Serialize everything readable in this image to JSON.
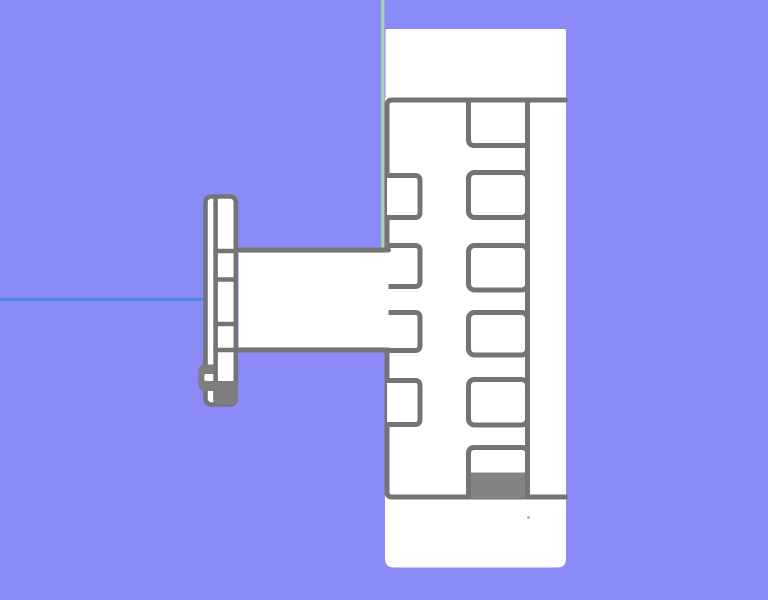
{
  "viewport": {
    "width": 768,
    "height": 600,
    "background": "#8b8bf7"
  },
  "axes": {
    "z_axis": {
      "color": "#a5d7a0",
      "x": 382.8,
      "y1": 0,
      "y2": 249,
      "width": 3.2
    },
    "x_axis": {
      "color": "#4d87e0",
      "y": 299.3,
      "x1": 0,
      "x2": 204,
      "width": 3
    }
  },
  "model": {
    "white": "#ffffff",
    "edge": "#747474",
    "solid": "#838383",
    "bump_fill": "#7e7e7e",
    "stroke_width": 5,
    "top_flange": {
      "x": 385.5,
      "y": 29,
      "w": 180.5,
      "h": 71,
      "r": 2
    },
    "bottom_flange": {
      "x": 385,
      "y": 499,
      "w": 181,
      "h": 68.5,
      "r": 9
    },
    "body": {
      "left": 387,
      "top": 100,
      "right": 565.5,
      "bottom": 497,
      "corner": 5,
      "fill": {
        "x": 385,
        "y": 98,
        "w": 181,
        "h": 401
      }
    },
    "beam": {
      "x1": 237.5,
      "x2": 388.5,
      "top": 250,
      "bottom": 350
    },
    "left_slots": {
      "x": 387,
      "w": 33,
      "r": 5,
      "items": [
        [
          175.5,
          42
        ],
        [
          245.5,
          41
        ],
        [
          312.5,
          38
        ],
        [
          380.5,
          44
        ]
      ]
    },
    "teeth": {
      "x": 468.5,
      "w": 59,
      "r": 6,
      "rail_x": 527.5,
      "top_tooth_bottom_y": 145.5,
      "items": [
        [
          172.5,
          45
        ],
        [
          245.5,
          44.5
        ],
        [
          312.5,
          42.5
        ],
        [
          379.5,
          45.5
        ]
      ],
      "bottom_tooth_top_y": 447.5,
      "bottom_fill_top_y": 472.5
    },
    "bracket": {
      "left": 205.5,
      "right": 235.8,
      "top": 196.5,
      "bottom": 404.5,
      "r": 5.5,
      "stroke_width": 4.6,
      "divider_x": 215.6,
      "rungs": [
        251,
        279.5,
        324,
        350
      ],
      "foot": {
        "x": 213.3,
        "top": 381,
        "right": 237.9,
        "bottom": 404.6,
        "r": 6
      },
      "bump": {
        "x": 198.3,
        "top": 364.5,
        "right": 215.6,
        "bottom": 391,
        "r": 7.5
      },
      "notch": {
        "x": 204.3,
        "y": 374,
        "w": 9.8,
        "h": 7,
        "r": 2
      }
    },
    "dot": {
      "x": 528.5,
      "y": 517.5,
      "r": 1.4
    }
  }
}
